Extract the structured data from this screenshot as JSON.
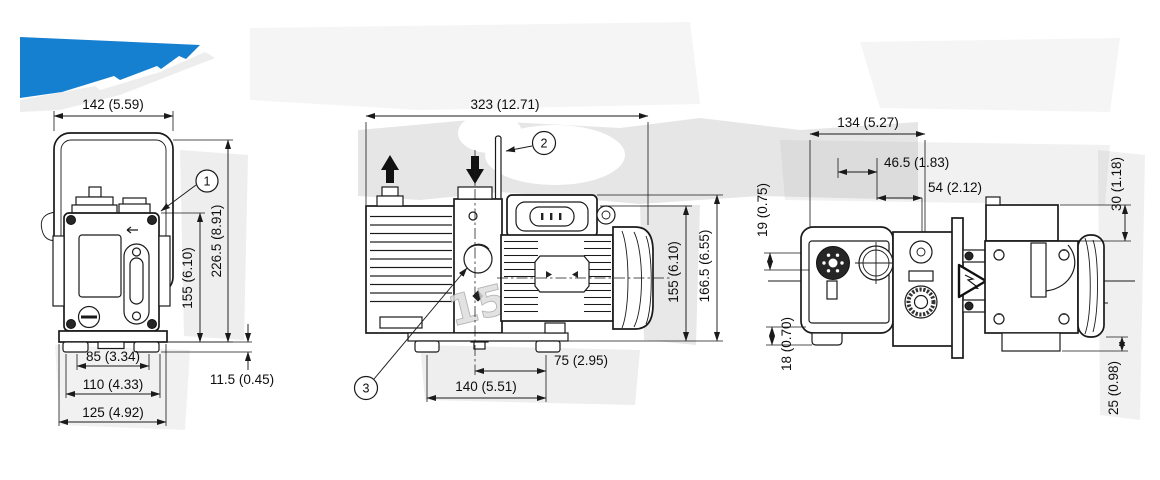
{
  "drawing_title": "vacuum pump dimensional drawing",
  "colors": {
    "accent": "#1580d0",
    "line": "#1a1a1a"
  },
  "views": {
    "front": {
      "label": "front view",
      "dims": {
        "handle_width": "142 (5.59)",
        "body_height": "155 (6.10)",
        "overall_height": "226.5 (8.91)",
        "foot_height": "11.5 (0.45)",
        "feet_inner_width": "85 (3.34)",
        "feet_outer_width": "110 (4.33)",
        "base_width": "125 (4.92)"
      },
      "callout_intake": "1"
    },
    "side": {
      "label": "side view",
      "dims": {
        "overall_length": "323 (12.71)",
        "body_height": "155 (6.10)",
        "overall_height": "166.5 (6.55)",
        "motor_foot_offset": "75 (2.95)",
        "feet_spacing": "140 (5.51)"
      },
      "callout_gas_ballast": "2",
      "callout_sight_glass": "3",
      "watermark": "15"
    },
    "top": {
      "label": "top view",
      "dims": {
        "overall_width": "134 (5.27)",
        "port_offset_inner": "46.5 (1.83)",
        "port_offset_outer": "54 (2.12)",
        "edge_offset_upper": "19 (0.75)",
        "edge_offset_lower": "18 (0.70)",
        "terminal_box_height": "30 (1.18)",
        "foot_height": "25 (0.98)"
      }
    }
  }
}
